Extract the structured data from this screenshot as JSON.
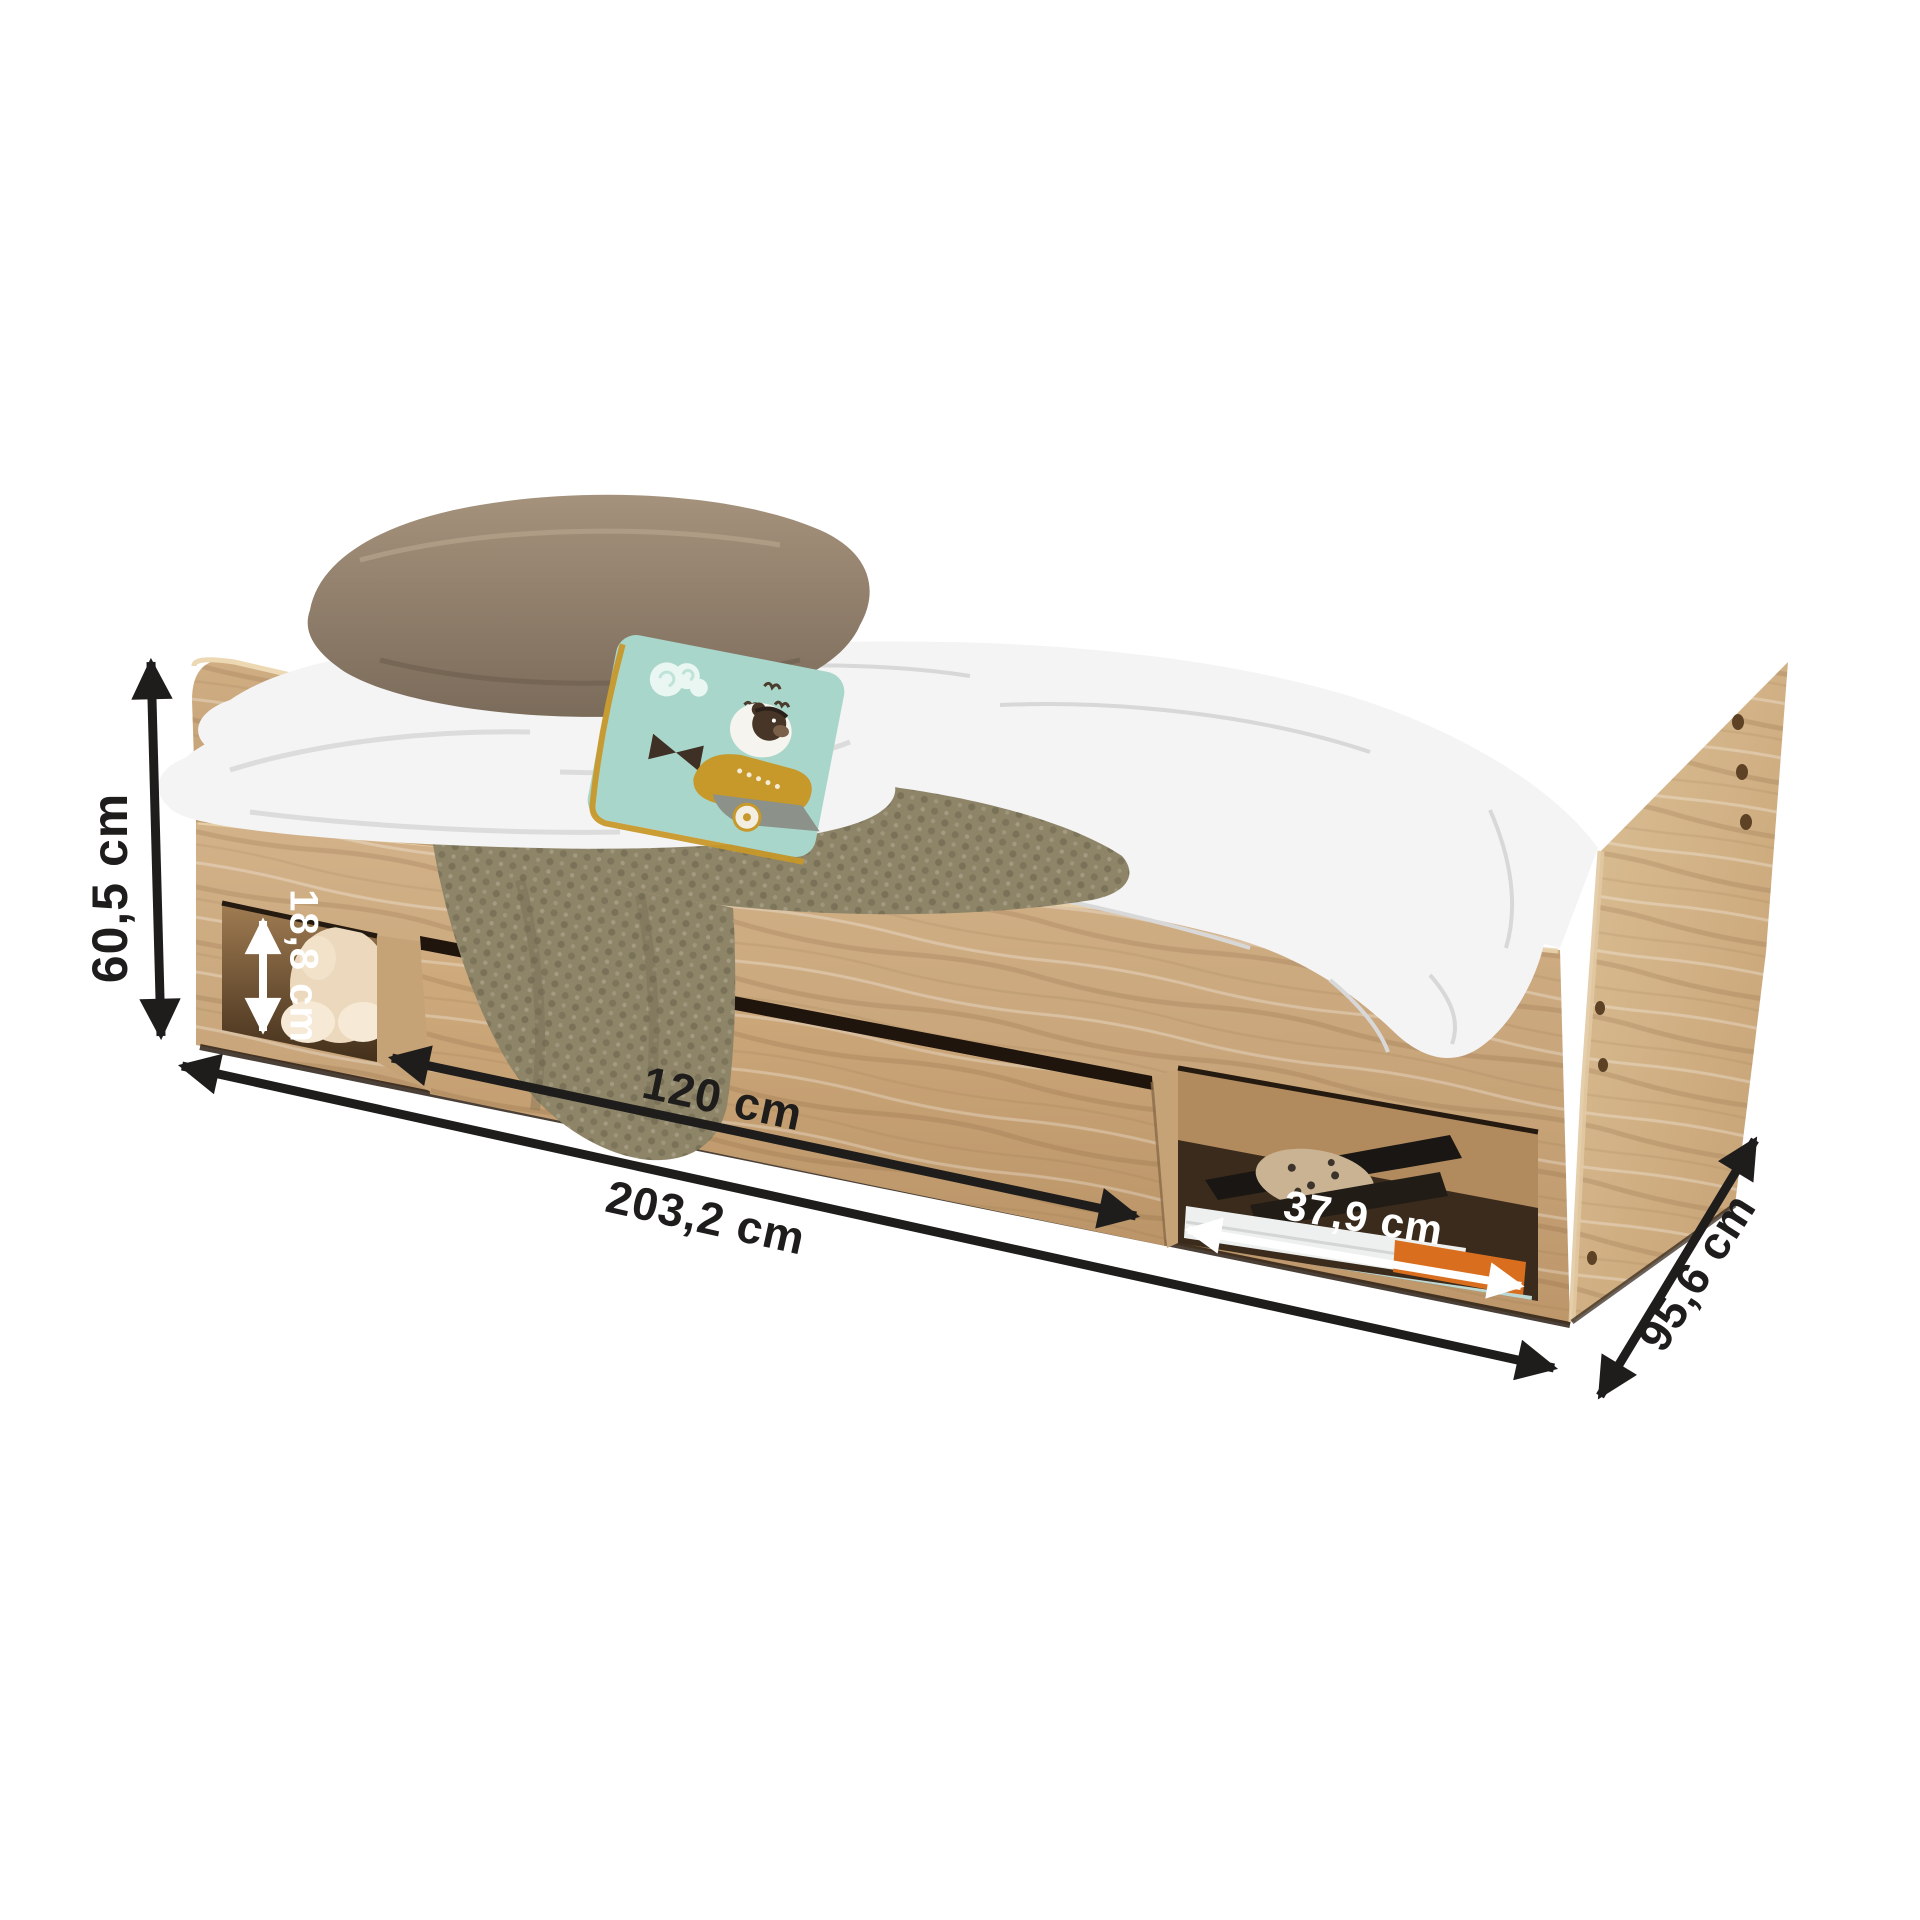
{
  "units": "cm",
  "dimensions": {
    "height": {
      "label": "60,5 cm",
      "color": "black"
    },
    "niche_height": {
      "label": "18,8 cm",
      "color": "white"
    },
    "drawer_width": {
      "label": "120 cm",
      "color": "black"
    },
    "length": {
      "label": "203,2 cm",
      "color": "black"
    },
    "niche_width": {
      "label": "37,9 cm",
      "color": "white"
    },
    "depth": {
      "label": "95,6 cm",
      "color": "black"
    }
  },
  "colors": {
    "background": "#ffffff",
    "wood": "#c8a477",
    "wood_light": "#d8bc92",
    "wood_shadow": "#a98159",
    "interior_dark": "#43301d",
    "bedding_white": "#f4f4f4",
    "blanket_olive": "#8e8568",
    "pillow_brown": "#8f7e6a",
    "cushion_teal": "#a9d6ca",
    "cushion_trim": "#c7982a",
    "annotation_black": "#1e1d1b",
    "annotation_white": "#ffffff"
  }
}
